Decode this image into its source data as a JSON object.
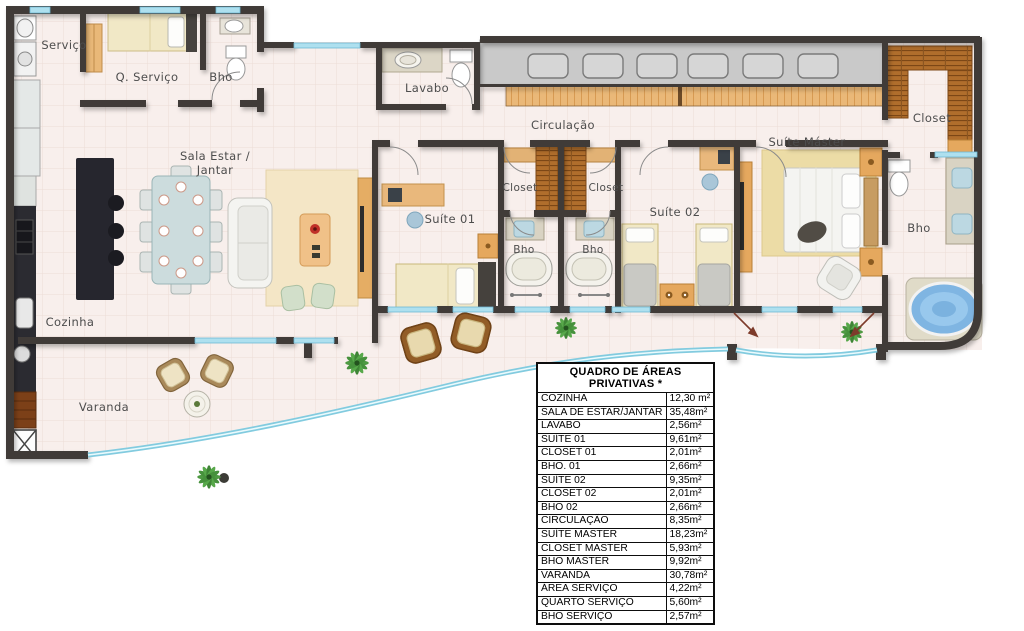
{
  "rooms": {
    "servico": {
      "label": "Serviço"
    },
    "q_servico": {
      "label": "Q. Serviço"
    },
    "bho_servico": {
      "label": "Bho"
    },
    "lavabo": {
      "label": "Lavabo"
    },
    "circulacao": {
      "label": "Circulação"
    },
    "sala": {
      "label_line1": "Sala Estar /",
      "label_line2": "Jantar"
    },
    "cozinha": {
      "label": "Cozinha"
    },
    "varanda": {
      "label": "Varanda"
    },
    "suite01": {
      "label": "Suíte 01"
    },
    "closet01": {
      "label": "Closet"
    },
    "closet02": {
      "label": "Closet"
    },
    "bho01": {
      "label": "Bho"
    },
    "bho02": {
      "label": "Bho"
    },
    "suite02": {
      "label": "Suíte 02"
    },
    "suite_master": {
      "label": "Suíte Máster"
    },
    "closet_master": {
      "label": "Closet"
    },
    "bho_master": {
      "label": "Bho"
    }
  },
  "areas_table": {
    "title": "QUADRO DE ÁREAS PRIVATIVAS *",
    "rows": [
      {
        "name": "COZINHA",
        "area": "12,30 m²"
      },
      {
        "name": "SALA DE ESTAR/JANTAR",
        "area": "35,48m²"
      },
      {
        "name": "LAVABO",
        "area": "2,56m²"
      },
      {
        "name": "SUÍTE 01",
        "area": "9,61m²"
      },
      {
        "name": "CLOSET 01",
        "area": "2,01m²"
      },
      {
        "name": "BHO. 01",
        "area": "2,66m²"
      },
      {
        "name": "SUÍTE 02",
        "area": "9,35m²"
      },
      {
        "name": "CLOSET 02",
        "area": "2,01m²"
      },
      {
        "name": "BHO 02",
        "area": "2,66m²"
      },
      {
        "name": "CIRCULAÇÃO",
        "area": "8,35m²"
      },
      {
        "name": "SUÍTE MASTER",
        "area": "18,23m²"
      },
      {
        "name": "CLOSET MASTER",
        "area": "5,93m²"
      },
      {
        "name": "BHO MASTER",
        "area": "9,92m²"
      },
      {
        "name": "VARANDA",
        "area": "30,78m²"
      },
      {
        "name": "ÁREA SERVIÇO",
        "area": "4,22m²"
      },
      {
        "name": "QUARTO SERVIÇO",
        "area": "5,60m²"
      },
      {
        "name": "BHO SERVIÇO",
        "area": "2,57m²"
      }
    ]
  },
  "colors": {
    "floor": "#f8efec",
    "wall": "#3f3b38",
    "glass": "#82cbdf",
    "wood_light": "#eab878",
    "wood_shelf": "#b06e2c",
    "granite": "#26262e",
    "bed_cream": "#f1e8c6",
    "rug": "#f4e6c6",
    "jacuzzi": "#7fb5e2",
    "arrow": "#7d3b2b",
    "gray_strip": "#c9c9c9"
  }
}
